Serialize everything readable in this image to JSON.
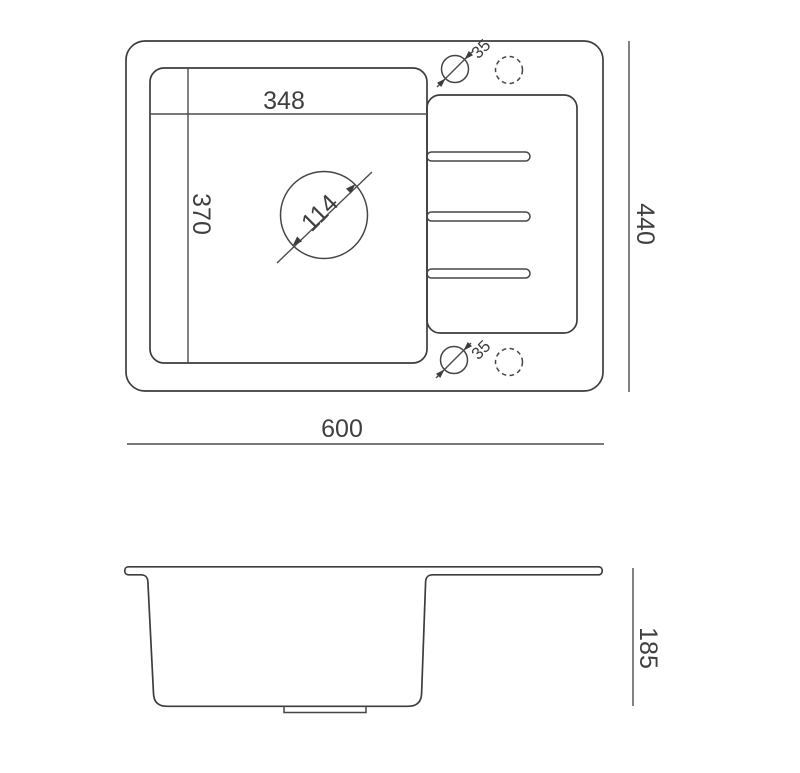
{
  "page": {
    "background": "#ffffff",
    "line_color": "#3d3d3d",
    "text_color": "#3f3f3f"
  },
  "drawing": {
    "dims": {
      "overall_width": "600",
      "overall_depth": "440",
      "bowl_width": "348",
      "bowl_depth": "370",
      "drain_diameter": "114",
      "hole_diameter_top": "35",
      "hole_diameter_bottom": "35",
      "overall_height": "185"
    }
  }
}
